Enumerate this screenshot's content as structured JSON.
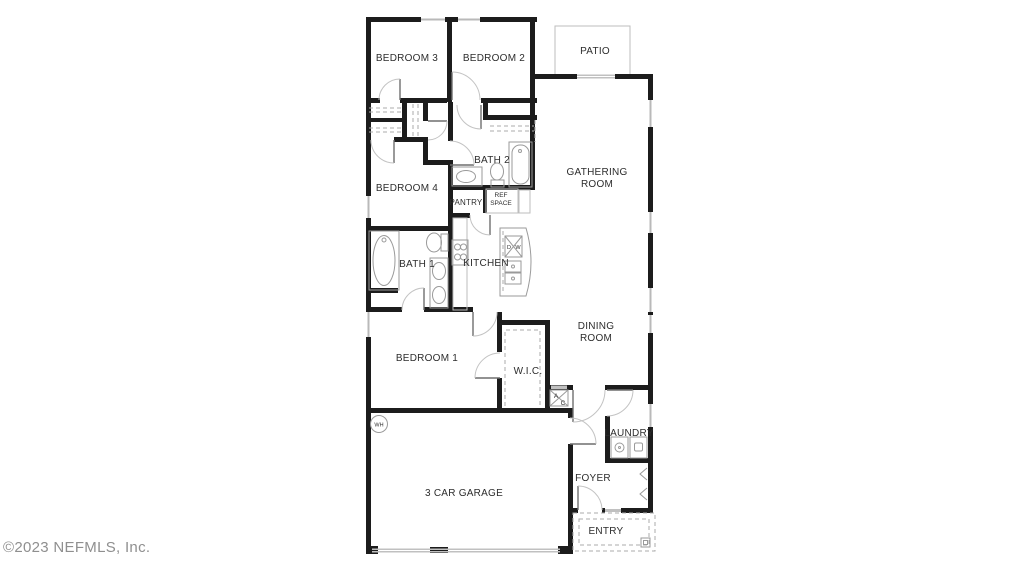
{
  "watermark": {
    "copyright": "©2023 NEFMLS, Inc."
  },
  "colors": {
    "background": "#ffffff",
    "walls": "#1c1c1c",
    "fixtures": "#9a9a9a",
    "labels": "#2d2d2d",
    "watermark_text": "#8f8f8f",
    "window_glass": "#b9b9b9"
  },
  "rooms": {
    "bedroom3": "BEDROOM 3",
    "bedroom2": "BEDROOM 2",
    "patio": "PATIO",
    "bath2": "BATH 2",
    "gathering_room_line1": "GATHERING",
    "gathering_room_line2": "ROOM",
    "bedroom4": "BEDROOM 4",
    "pantry": "PANTRY",
    "ref_space_line1": "REF",
    "ref_space_line2": "SPACE",
    "bath1": "BATH 1",
    "kitchen": "KITCHEN",
    "dining_room_line1": "DINING",
    "dining_room_line2": "ROOM",
    "bedroom1": "BEDROOM 1",
    "wic": "W.I.C.",
    "laundry": "LAUNDRY",
    "garage": "3 CAR GARAGE",
    "foyer": "FOYER",
    "entry": "ENTRY"
  },
  "fixtures": {
    "dishwasher_d": "D",
    "dishwasher_w": "W",
    "ac_a": "A",
    "ac_c": "C",
    "water_heater": "WH"
  }
}
